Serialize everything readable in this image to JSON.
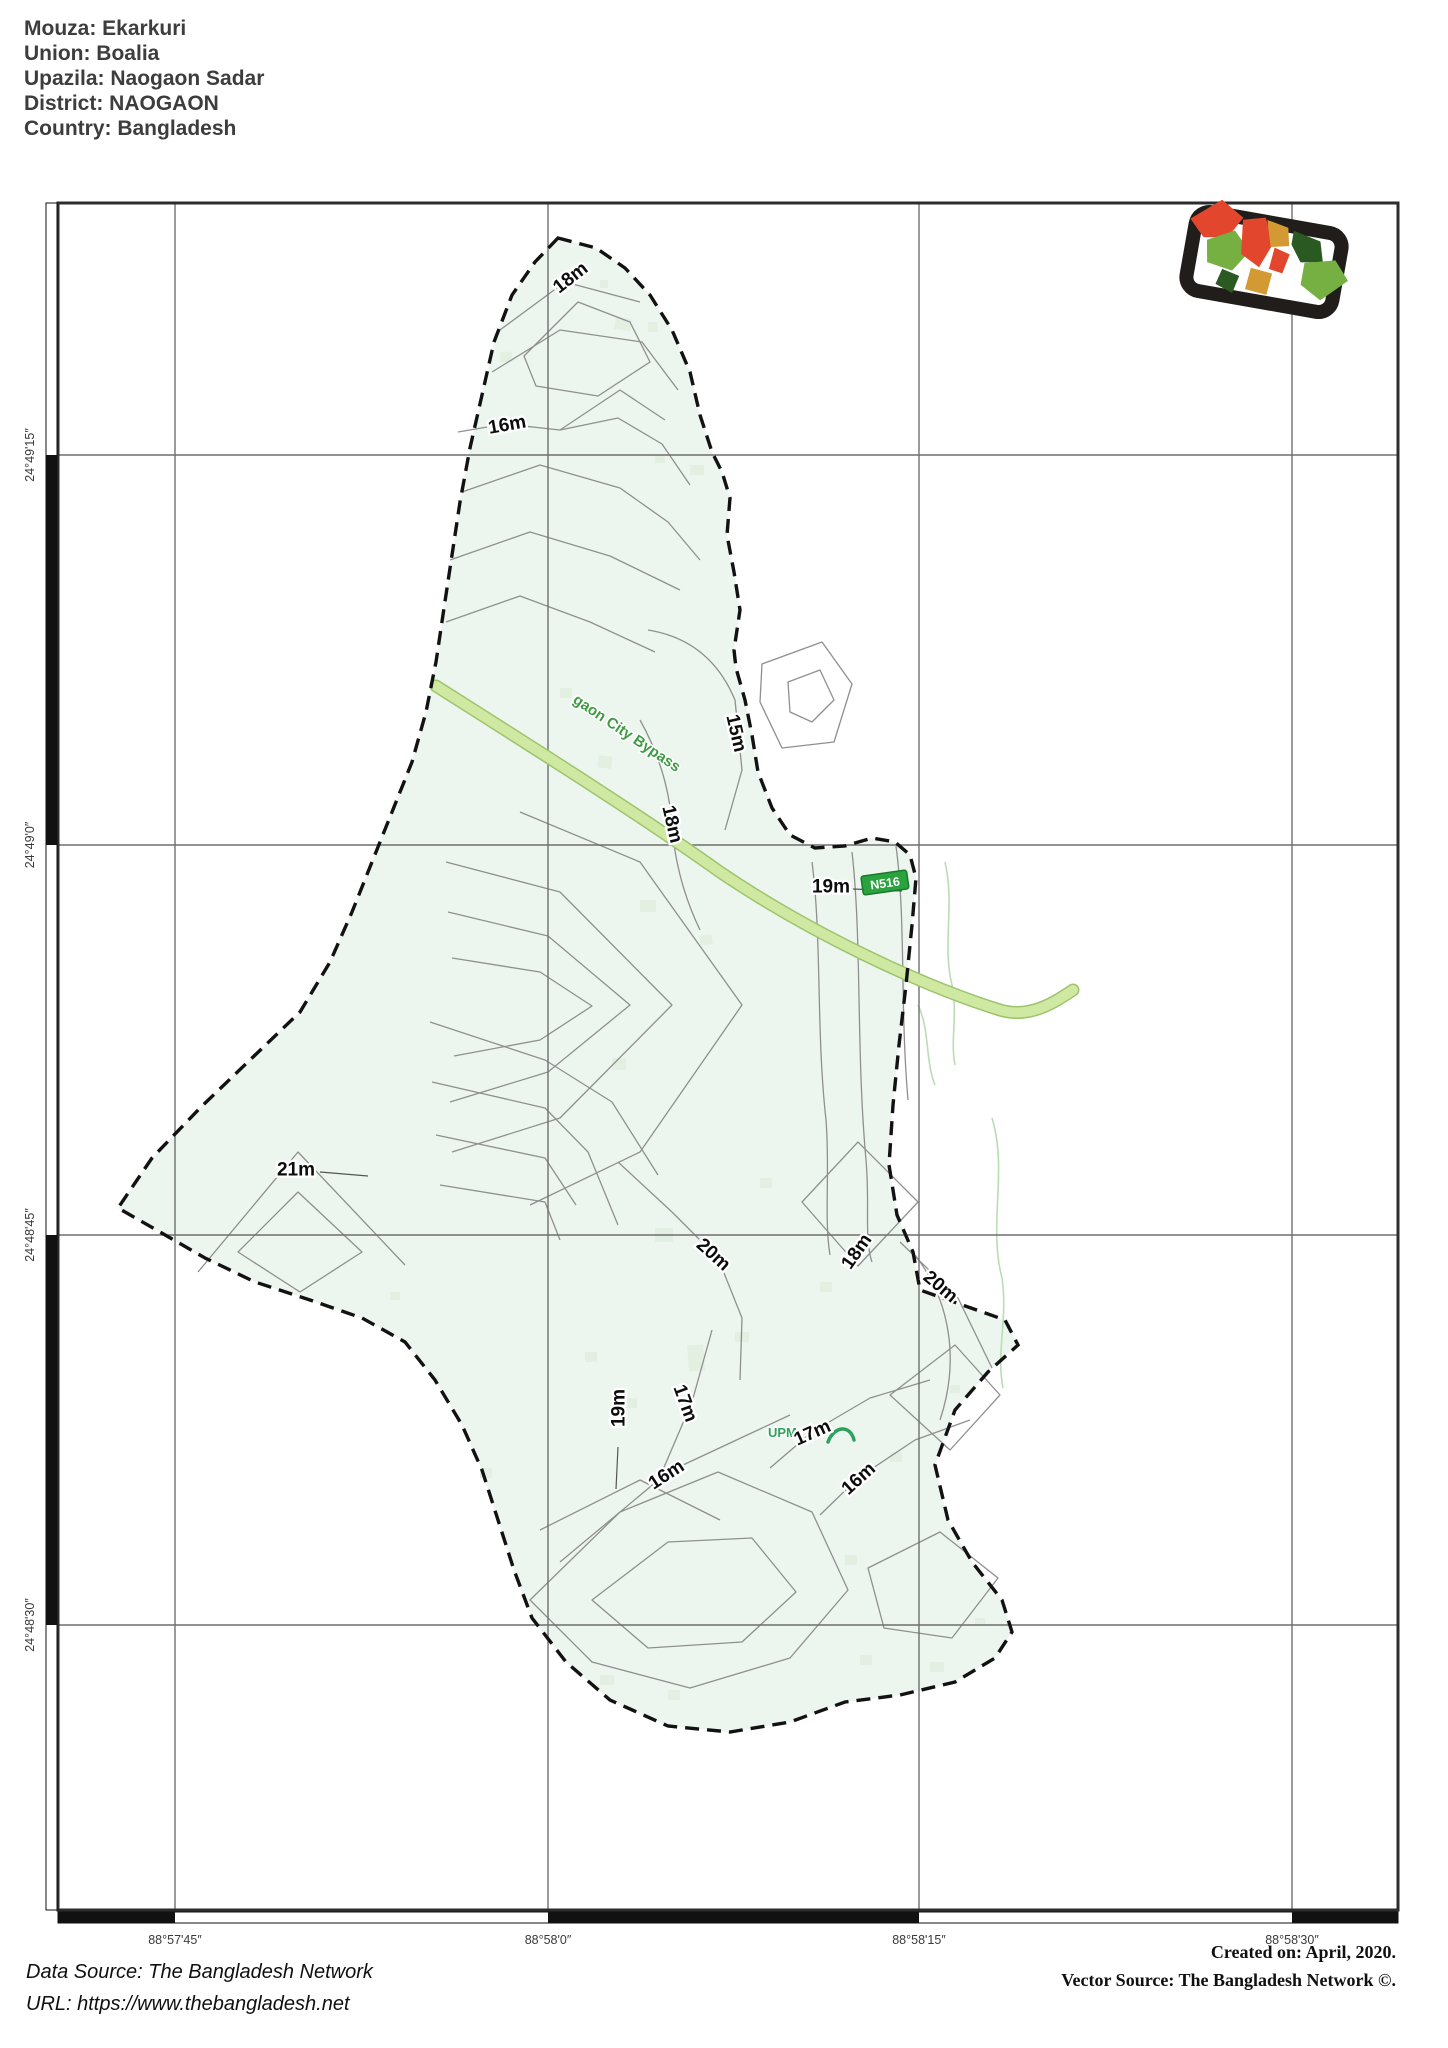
{
  "header": {
    "lines": [
      "Mouza: Ekarkuri",
      "Union: Boalia",
      "Upazila: Naogaon Sadar",
      "District: NAOGAON",
      "Country: Bangladesh"
    ]
  },
  "axes": {
    "bottom": [
      "88°57'45″",
      "88°58'0″",
      "88°58'15″",
      "88°58'30″"
    ],
    "left": [
      "24°49'15″",
      "24°49'0″",
      "24°48'45″",
      "24°48'30″"
    ]
  },
  "map": {
    "colors": {
      "land": "#edf6ee",
      "contour": "#8f8f8f",
      "boundary": "#121212",
      "grid": "#6f6f6f",
      "road_fill": "#cfe9a2",
      "road_casing": "#9dc46d",
      "road_label": "#3f9b43",
      "badge_bg": "#2aa23e",
      "patch": "#e2efe1",
      "stream": "#b9ddb4"
    },
    "road": {
      "name": "gaon City Bypass",
      "ref": "N516"
    },
    "minor_road_label": "UPM",
    "contour_labels": [
      {
        "text": "18m",
        "x": 570,
        "y": 277,
        "rot": -38
      },
      {
        "text": "16m",
        "x": 507,
        "y": 424,
        "rot": -10
      },
      {
        "text": "15m",
        "x": 737,
        "y": 733,
        "rot": 77
      },
      {
        "text": "18m",
        "x": 673,
        "y": 824,
        "rot": 77
      },
      {
        "text": "19m",
        "x": 831,
        "y": 886,
        "rot": 0
      },
      {
        "text": "20m",
        "x": 714,
        "y": 1254,
        "rot": 42
      },
      {
        "text": "18m",
        "x": 856,
        "y": 1251,
        "rot": -55
      },
      {
        "text": "20m",
        "x": 941,
        "y": 1286,
        "rot": 40
      },
      {
        "text": "19m",
        "x": 618,
        "y": 1408,
        "rot": -90
      },
      {
        "text": "17m",
        "x": 686,
        "y": 1403,
        "rot": 70
      },
      {
        "text": "16m",
        "x": 666,
        "y": 1474,
        "rot": -33
      },
      {
        "text": "17m",
        "x": 812,
        "y": 1432,
        "rot": -24
      },
      {
        "text": "16m",
        "x": 858,
        "y": 1478,
        "rot": -42
      },
      {
        "text": "21m",
        "x": 296,
        "y": 1169,
        "rot": 0
      }
    ],
    "logo": {
      "name": "bangladesh-divisions-logo",
      "frame": "#201d1a",
      "red": "#e2472e",
      "green": "#76b043",
      "dark_green": "#2a5a21",
      "orange": "#d39a33"
    }
  },
  "footer": {
    "data_source": "Data Source: The Bangladesh Network",
    "url": "URL: https://www.thebangladesh.net",
    "created": "Created on: April, 2020.",
    "vector_source": "Vector Source: The Bangladesh Network ©."
  }
}
